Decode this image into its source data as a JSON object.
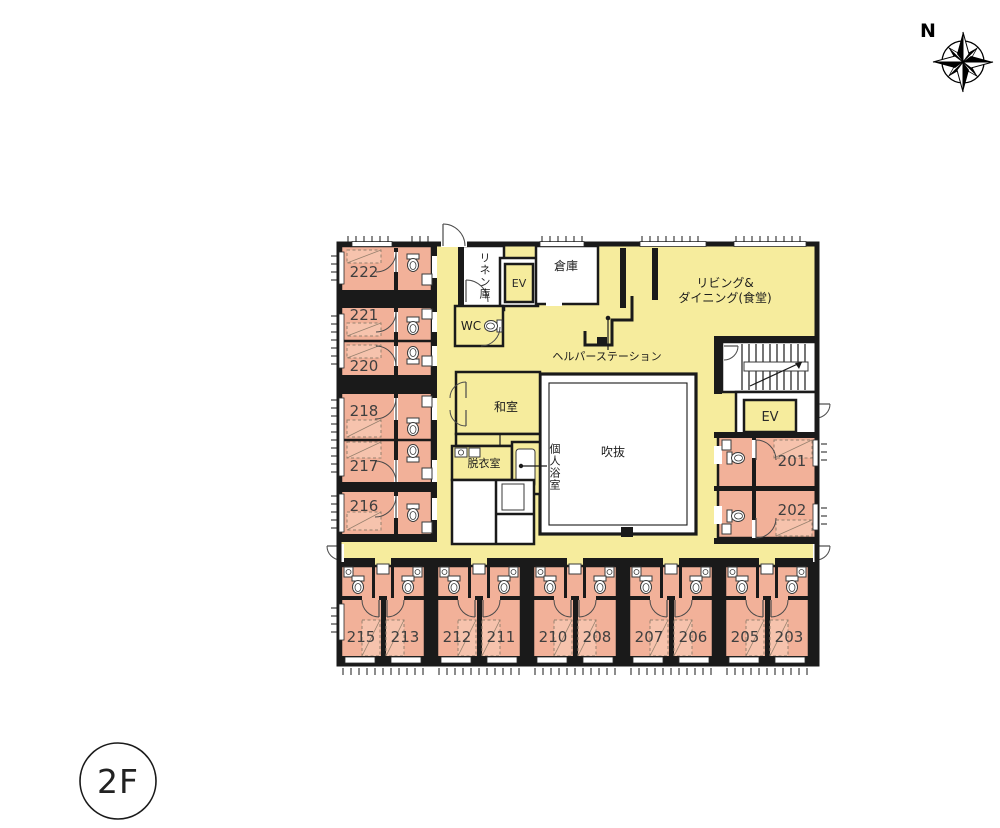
{
  "page": {
    "floor_label": "2F",
    "compass_label": "N"
  },
  "rooms": {
    "r201": "201",
    "r202": "202",
    "r203": "203",
    "r205": "205",
    "r206": "206",
    "r207": "207",
    "r208": "208",
    "r210": "210",
    "r211": "211",
    "r212": "212",
    "r213": "213",
    "r215": "215",
    "r216": "216",
    "r217": "217",
    "r218": "218",
    "r220": "220",
    "r221": "221",
    "r222": "222"
  },
  "labels": {
    "linen": "リネン庫",
    "ev": "EV",
    "storage": "倉庫",
    "living_line1": "リビング&",
    "living_line2": "ダイニング(食堂)",
    "wc": "WC",
    "helper_station": "ヘルパーステーション",
    "japanese_room": "和室",
    "dressing_room": "脱衣室",
    "private_bath": "個人浴室",
    "atrium": "吹抜"
  },
  "colors": {
    "room_fill": "#f2b199",
    "common_fill": "#f6ec9d",
    "bed_fill": "#f6c3ad",
    "wall": "#1a1a1a"
  }
}
